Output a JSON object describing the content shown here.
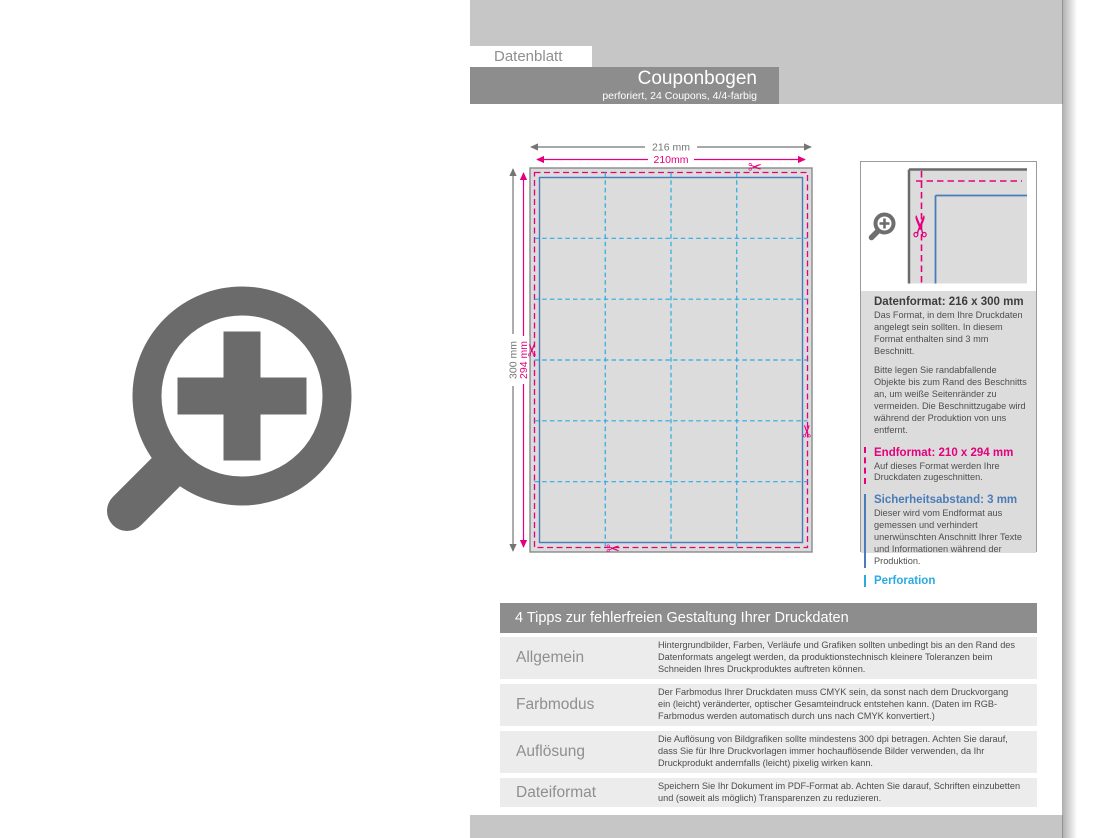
{
  "header": {
    "datenblatt_label": "Datenblatt",
    "product_title": "Couponbogen",
    "product_subtitle": "perforiert, 24 Coupons, 4/4-farbig"
  },
  "diagram": {
    "dim_outer_width": "216 mm",
    "dim_inner_width": "210mm",
    "dim_outer_height": "300 mm",
    "dim_inner_height": "294 mm",
    "grid_cols": 4,
    "grid_rows": 6,
    "scissors_glyph": "✂"
  },
  "info_panel": {
    "sections": [
      {
        "title": "Datenformat: 216 x 300 mm",
        "body": [
          "Das Format, in dem Ihre Druckdaten angelegt sein sollten. In diesem Format enthalten sind 3 mm Beschnitt.",
          "Bitte legen Sie randabfallende Objekte bis zum Rand des Beschnitts an, um weiße Seitenränder zu vermeiden. Die Beschnittzugabe wird während der Produktion von uns entfernt."
        ]
      },
      {
        "title": "Endformat: 210 x 294 mm",
        "body": [
          "Auf dieses Format werden Ihre Druckdaten zugeschnitten."
        ]
      },
      {
        "title": "Sicherheitsabstand: 3 mm",
        "body": [
          "Dieser wird vom Endformat aus gemessen und verhindert unerwünschten Anschnitt Ihrer Texte und Informationen während der Produktion."
        ]
      },
      {
        "title": "Perforation",
        "body": []
      }
    ]
  },
  "tips": {
    "header": "4 Tipps zur fehlerfreien Gestaltung Ihrer Druckdaten",
    "rows": [
      {
        "label": "Allgemein",
        "text": "Hintergrundbilder, Farben, Verläufe und Grafiken sollten unbedingt bis an den Rand des Datenformats angelegt werden, da produktionstechnisch kleinere Toleranzen beim Schneiden Ihres Druckproduktes auftreten können."
      },
      {
        "label": "Farbmodus",
        "text": "Der Farbmodus Ihrer Druckdaten muss CMYK sein, da sonst nach dem Druckvorgang ein (leicht) veränderter, optischer Gesamteindruck entstehen kann. (Daten im RGB-Farbmodus werden automatisch durch uns nach CMYK konvertiert.)"
      },
      {
        "label": "Auflösung",
        "text": "Die Auflösung von Bildgrafiken sollte mindestens 300 dpi betragen. Achten Sie darauf, dass Sie für Ihre Druckvorlagen immer hochauflösende Bilder verwenden, da Ihr Druckprodukt andernfalls (leicht) pixelig wirken kann."
      },
      {
        "label": "Dateiformat",
        "text": "Speichern Sie Ihr Dokument im PDF-Format ab. Achten Sie darauf, Schriften einzubetten und (soweit als möglich) Transparenzen zu reduzieren."
      }
    ]
  },
  "colors": {
    "accent_magenta": "#e5007d",
    "accent_blue": "#4a7cb8",
    "accent_cyan": "#29abe2",
    "bar_gray": "#8d8d8d",
    "band_gray": "#c6c6c6",
    "sheet_fill": "#dcdcdc"
  }
}
